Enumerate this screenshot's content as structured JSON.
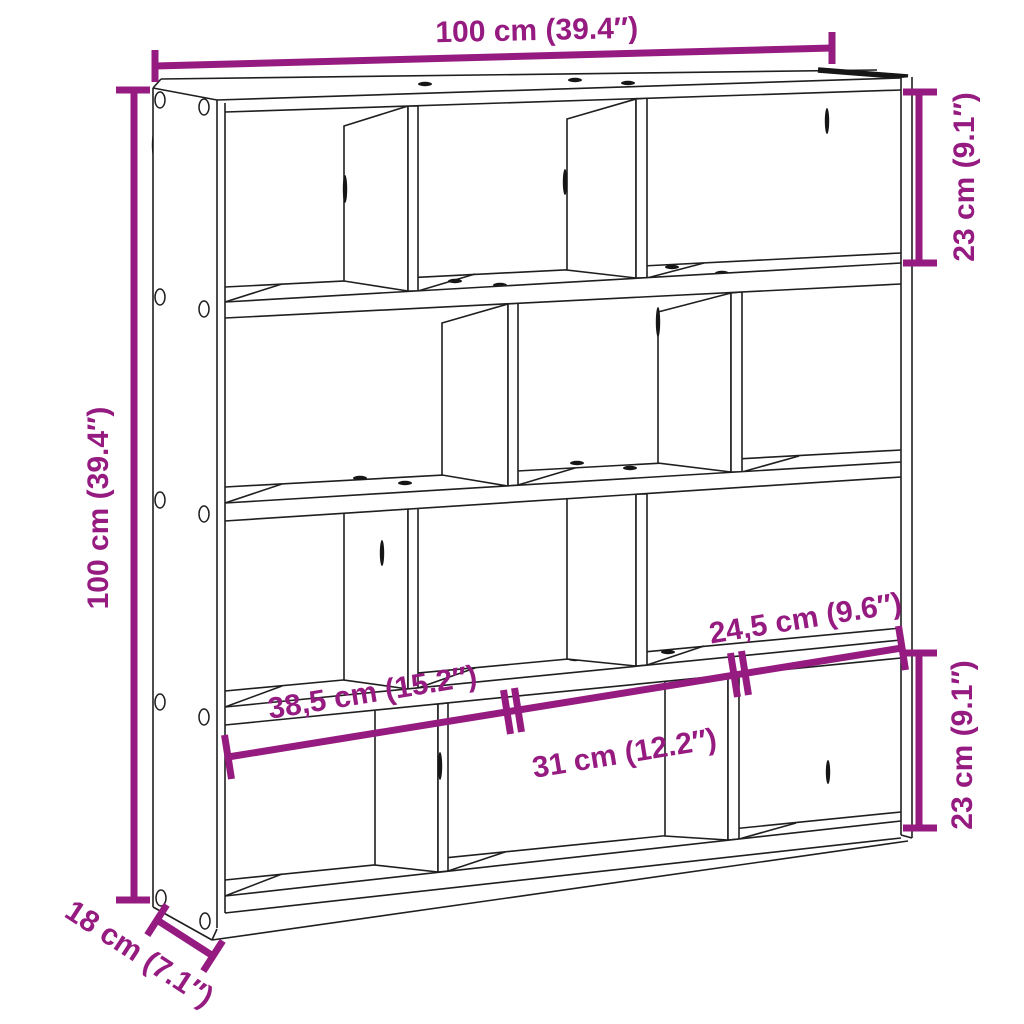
{
  "colors": {
    "accent": "#951b81",
    "lines": "#1f1f1f",
    "background": "#ffffff"
  },
  "diagram": {
    "dimensions": {
      "top_width": "100 cm (39.4″)",
      "left_height": "100 cm (39.4″)",
      "right_top_cell": "23 cm (9.1″)",
      "right_bottom_cell": "23 cm (9.1″)",
      "cell_width_left": "38,5 cm (15.2″)",
      "cell_width_middle": "31 cm (12.2″)",
      "cell_width_right": "24,5 cm (9.6″)",
      "depth": "18 cm (7.1″)"
    }
  }
}
